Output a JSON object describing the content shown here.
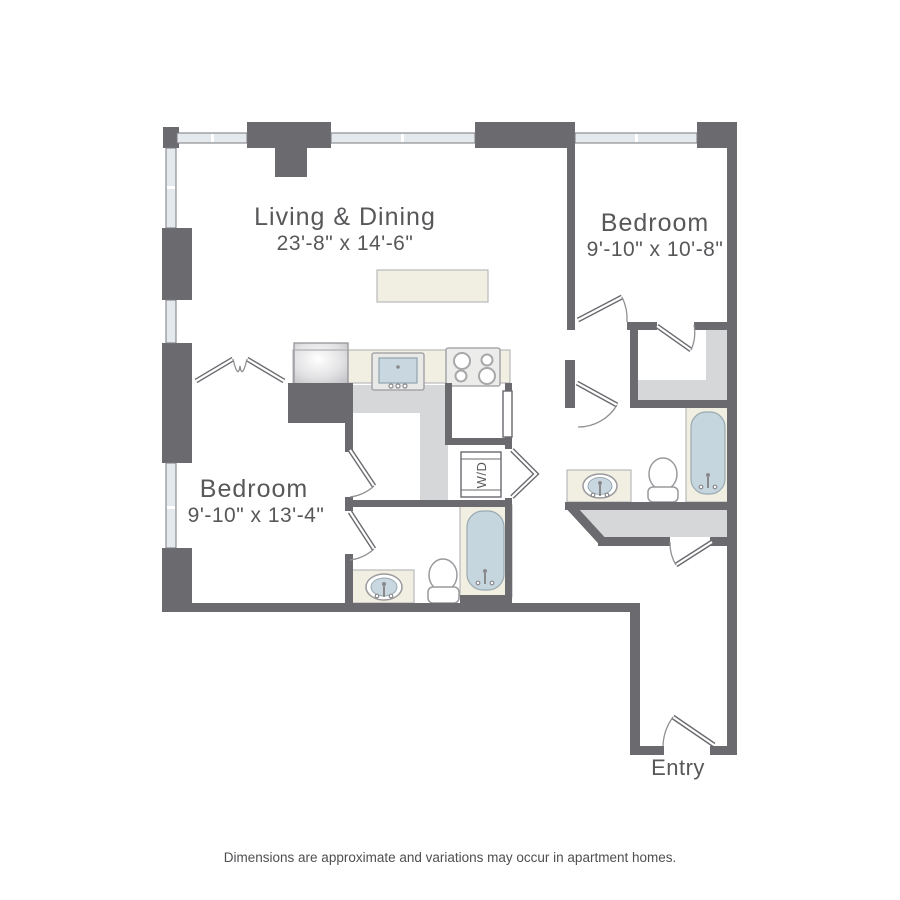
{
  "plan": {
    "rooms": [
      {
        "id": "living-dining",
        "name": "Living & Dining",
        "dimensions": "23'-8\" x 14'-6\""
      },
      {
        "id": "bedroom-right",
        "name": "Bedroom",
        "dimensions": "9'-10\" x 10'-8\""
      },
      {
        "id": "bedroom-left",
        "name": "Bedroom",
        "dimensions": "9'-10\" x 13'-4\""
      }
    ],
    "entry_label": "Entry",
    "washer_dryer_label": "W/D"
  },
  "footer": {
    "disclaimer": "Dimensions are approximate and variations may occur in apartment homes."
  },
  "colors": {
    "wall": "#6a6a6f",
    "window": "#e3e9ec",
    "closet_shade": "#d5d7d9",
    "fixture_beige": "#f1efe1",
    "water_blue": "#c6d6de",
    "label_text": "#58585b"
  }
}
